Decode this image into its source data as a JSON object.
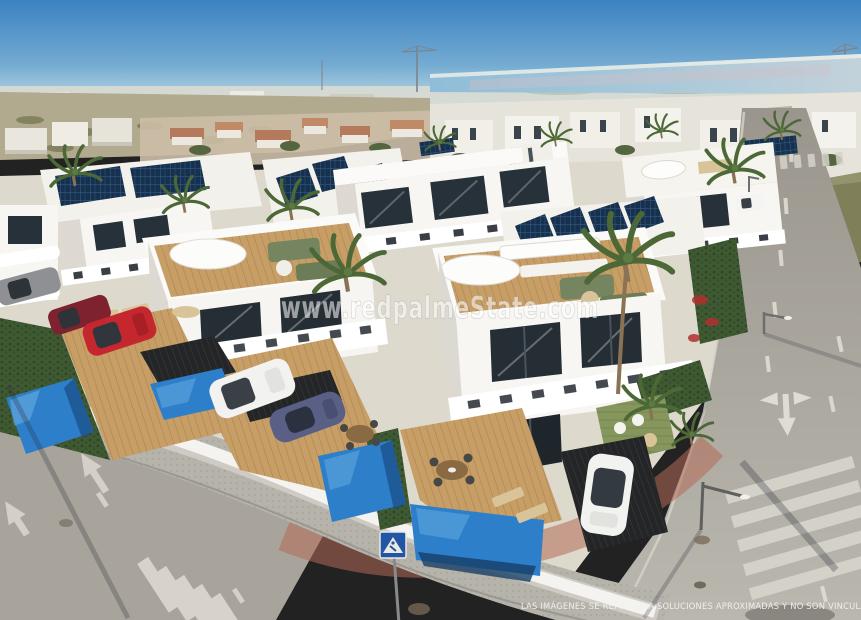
{
  "image": {
    "kind": "aerial 3D architectural render",
    "subject": "Modern white villa development with private pools, rooftop solar panels, palm trees, parked cars and surrounding roads; salt lagoon and distant town on the horizon",
    "width_px": 861,
    "height_px": 620
  },
  "watermark": {
    "text": "www.redpalmeState.com"
  },
  "disclaimer": {
    "text": "LAS IMÁGENES SE REFIEREN A SOLUCIONES APROXIMADAS Y NO SON VINCULANTES AL PRO"
  },
  "palette": {
    "sky_top": "#3a82c1",
    "sky_horizon": "#cfe0e6",
    "lagoon": "#9cc5da",
    "distant_city": "#d9dad3",
    "field_tan": "#b2aa8e",
    "terracotta": "#b5795c",
    "villa_white": "#f7f6f2",
    "villa_shadow": "#dcd9d2",
    "parapet_white": "#ffffff",
    "window_dark": "#27313a",
    "glass_dark": "#1f262b",
    "pool_blue": "#2e7fc9",
    "pool_deep": "#1a4c85",
    "deck_wood": "#c79e66",
    "solar_dark": "#16314e",
    "road_gray": "#a8a49b",
    "sidewalk_gray": "#b6b3ab",
    "red_pavement": "#b26a55",
    "marking_white": "#e3e0d7",
    "grass_green": "#86975d",
    "hedge_green": "#3f5a33",
    "palm_green": "#4c6837",
    "trunk_brown": "#8a7355",
    "car_red": "#c4272e",
    "car_maroon": "#7e2230",
    "car_blue": "#5a5f86",
    "car_white": "#f2f2f0",
    "car_gray": "#8e9094",
    "sign_blue": "#2256a5",
    "sofa_green": "#75855f",
    "lounger_tan": "#d9c49a"
  }
}
